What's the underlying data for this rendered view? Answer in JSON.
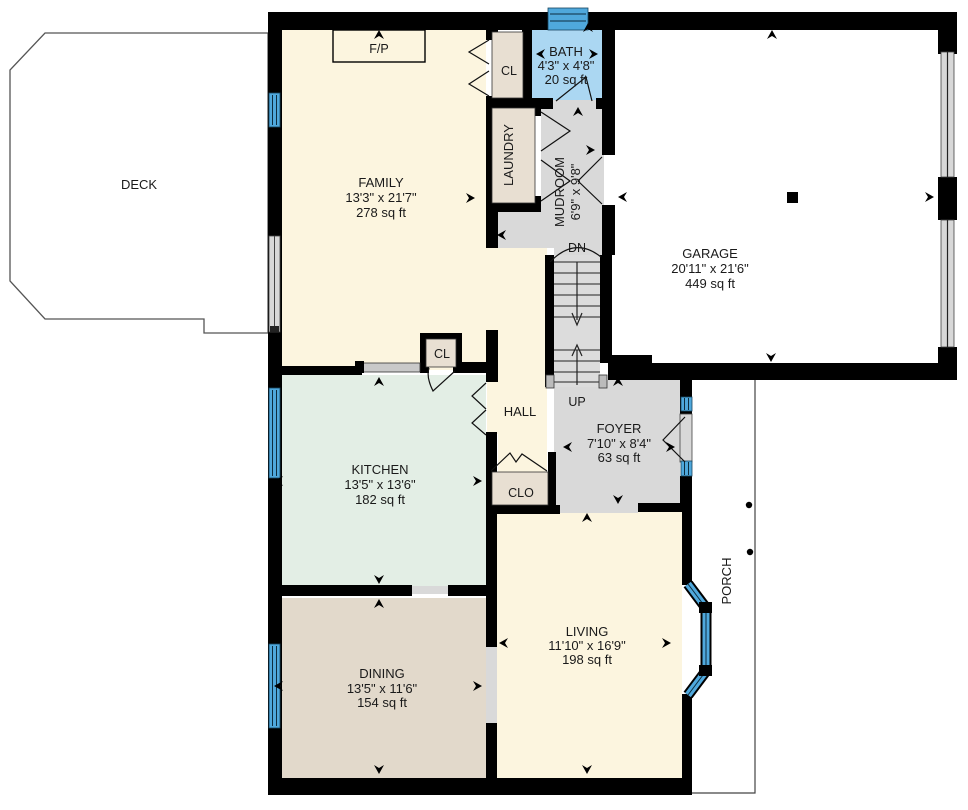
{
  "rooms": {
    "deck": {
      "label": "DECK"
    },
    "family": {
      "label": "FAMILY",
      "dims": "13'3\" x 21'7\"",
      "area": "278 sq ft"
    },
    "bath": {
      "label": "BATH",
      "dims": "4'3\" x 4'8\"",
      "area": "20 sq ft"
    },
    "laundry": {
      "label": "LAUNDRY"
    },
    "mudroom": {
      "label": "MUDROOM",
      "dims": "6'9\" x 9'8\""
    },
    "garage": {
      "label": "GARAGE",
      "dims": "20'11\" x 21'6\"",
      "area": "449 sq ft"
    },
    "kitchen": {
      "label": "KITCHEN",
      "dims": "13'5\" x 13'6\"",
      "area": "182 sq ft"
    },
    "hall": {
      "label": "HALL"
    },
    "foyer": {
      "label": "FOYER",
      "dims": "7'10\" x 8'4\"",
      "area": "63 sq ft"
    },
    "dining": {
      "label": "DINING",
      "dims": "13'5\" x 11'6\"",
      "area": "154 sq ft"
    },
    "living": {
      "label": "LIVING",
      "dims": "11'10\" x 16'9\"",
      "area": "198 sq ft"
    },
    "porch": {
      "label": "PORCH"
    }
  },
  "annotations": {
    "fireplace": "F/P",
    "family_closet": "CL",
    "kitchen_closet": "CL",
    "hall_closet": "CLO",
    "stairs_down": "DN",
    "stairs_up": "UP"
  },
  "colors": {
    "wall": "#000000",
    "floor_cream": "#FCF5DF",
    "floor_mint": "#E3EEE5",
    "floor_tan": "#E2D9CB",
    "floor_gray": "#D9D9D9",
    "closet_beige": "#E8DFD2",
    "bath_blue": "#ABD7F2",
    "window_blue": "#4FA8DC"
  }
}
